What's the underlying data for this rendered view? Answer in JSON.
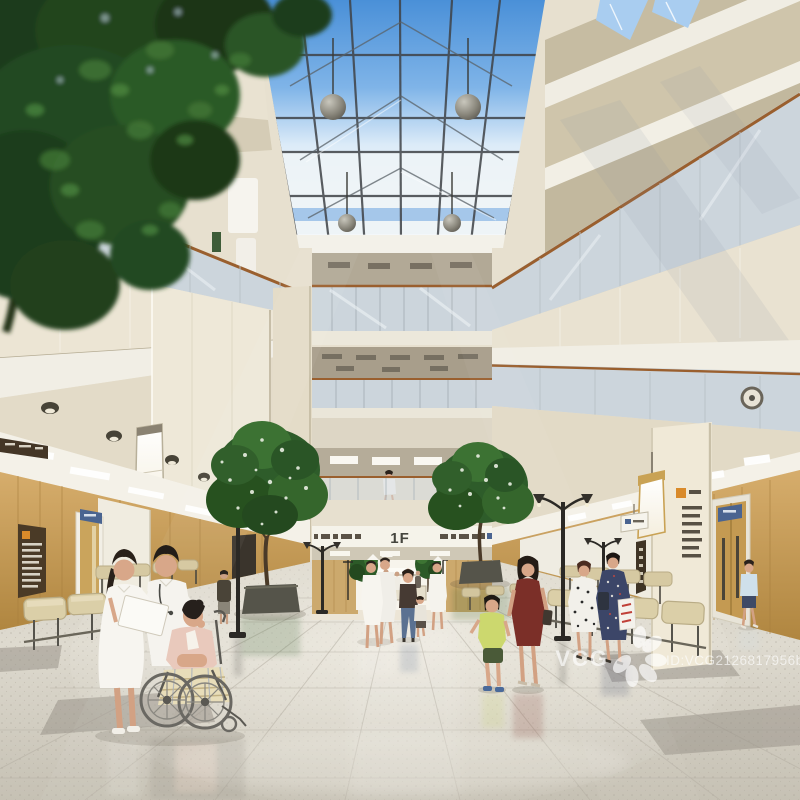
{
  "meta": {
    "alt": "3D architectural rendering of a sunlit hospital atrium lobby: gabled glass skylight, multi-storey beige balconies, indoor trees, waiting benches, medical staff, a patient in a wheelchair and visitors on a polished terrazzo floor"
  },
  "signs": {
    "floor_level": "1F"
  },
  "watermark": {
    "brand": "VCG",
    "id_text": "ID:VCG2126817956b"
  },
  "palette": {
    "sky_top": "#4a90d8",
    "sky_mid": "#7fb4e8",
    "sky_pale": "#dcebf8",
    "diffuse": "#eff4f8",
    "facade": "#e7e0cf",
    "facade_shade": "#cdc4ac",
    "trim": "#f2efe6",
    "glass": "#ccd5dc",
    "handrail": "#9a5f2e",
    "wood": "#caa160",
    "floor": "#dedacf",
    "floor_edge": "#c6c1b4",
    "bench": "#d8cba2",
    "foliage_dark": "#1f4220",
    "foliage_light": "#4f8c41",
    "accent_orange": "#d98a2a",
    "sign_blue": "#4a6490",
    "watermark_white": "#ffffff"
  }
}
